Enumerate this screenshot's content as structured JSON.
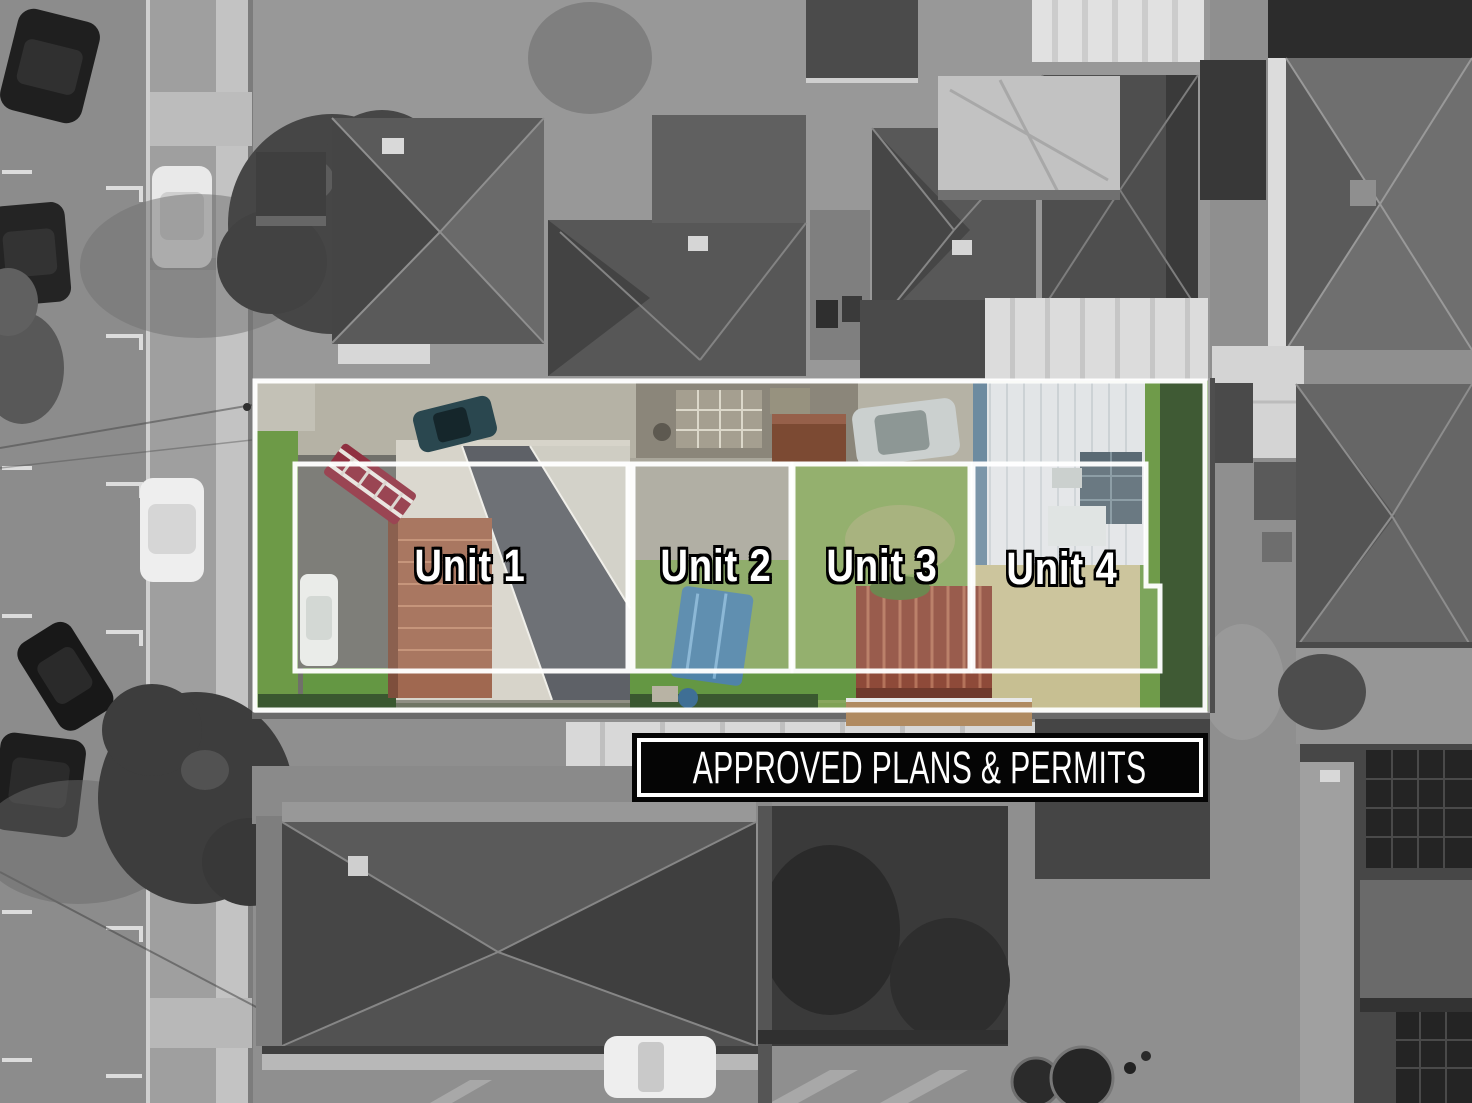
{
  "overlay": {
    "units": [
      {
        "label": "Unit 1"
      },
      {
        "label": "Unit 2"
      },
      {
        "label": "Unit 3"
      },
      {
        "label": "Unit 4"
      }
    ],
    "banner": {
      "text": "APPROVED PLANS & PERMITS"
    }
  },
  "colors": {
    "boundary_outline": "#ffffff",
    "banner_background": "#000000",
    "banner_border": "#ffffff",
    "banner_text": "#ffffff",
    "unit_label_fill": "#ffffff",
    "unit_label_outline": "#000000",
    "highlight_grass_green": "#7fa255",
    "dry_grass": "#c7bf92"
  }
}
